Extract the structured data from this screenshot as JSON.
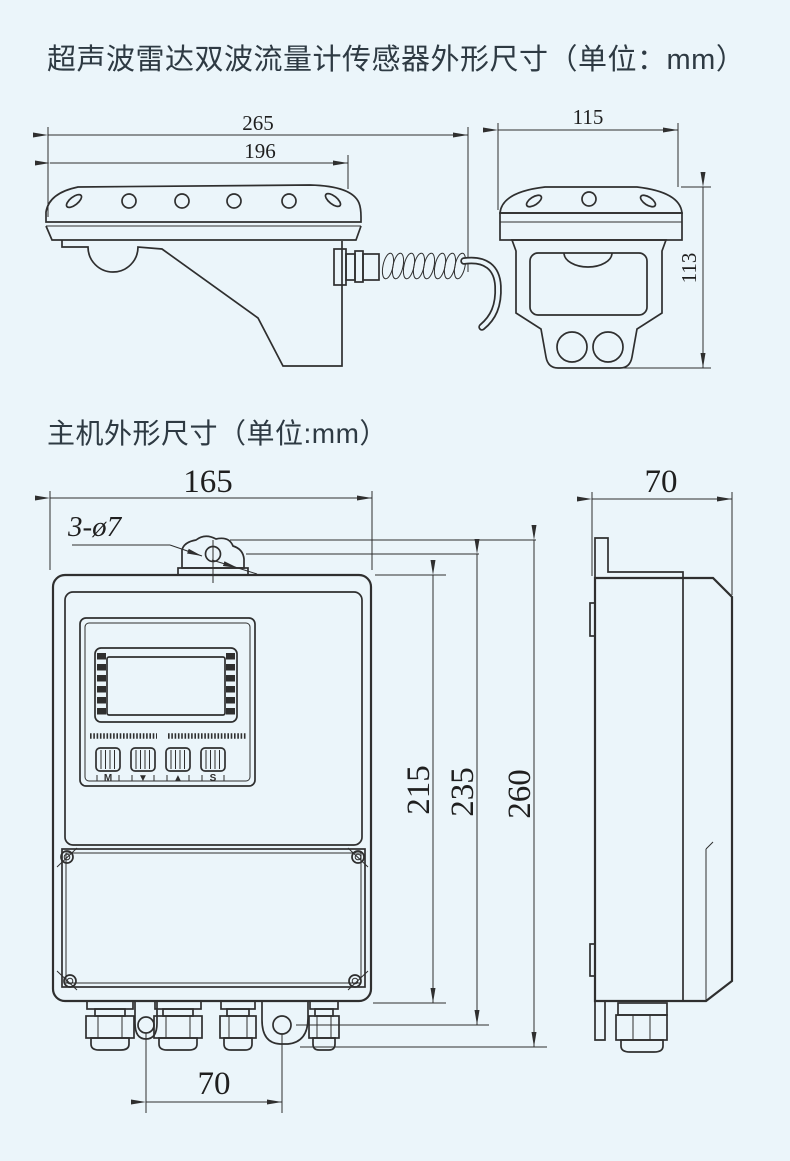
{
  "colors": {
    "background": "#ebf5fa",
    "line_color": "#2f2f2f",
    "title_color": "#2e3a43"
  },
  "sensor_section": {
    "title": "超声波雷达双波流量计传感器外形尺寸（单位：mm）",
    "side_view": {
      "dim_overall_width": "265",
      "dim_top_width": "196"
    },
    "front_view": {
      "dim_width": "115",
      "dim_height": "113"
    }
  },
  "main_section": {
    "title": "主机外形尺寸（单位:mm）",
    "front_view": {
      "dim_width": "165",
      "dim_mount_holes": "3-ø7",
      "dim_height_body": "215",
      "dim_height_mount": "235",
      "dim_height_overall": "260",
      "dim_bottom_hole_span": "70",
      "keypad_labels": [
        "M",
        "▼",
        "▲",
        "S"
      ]
    },
    "side_view": {
      "dim_depth": "70"
    }
  }
}
